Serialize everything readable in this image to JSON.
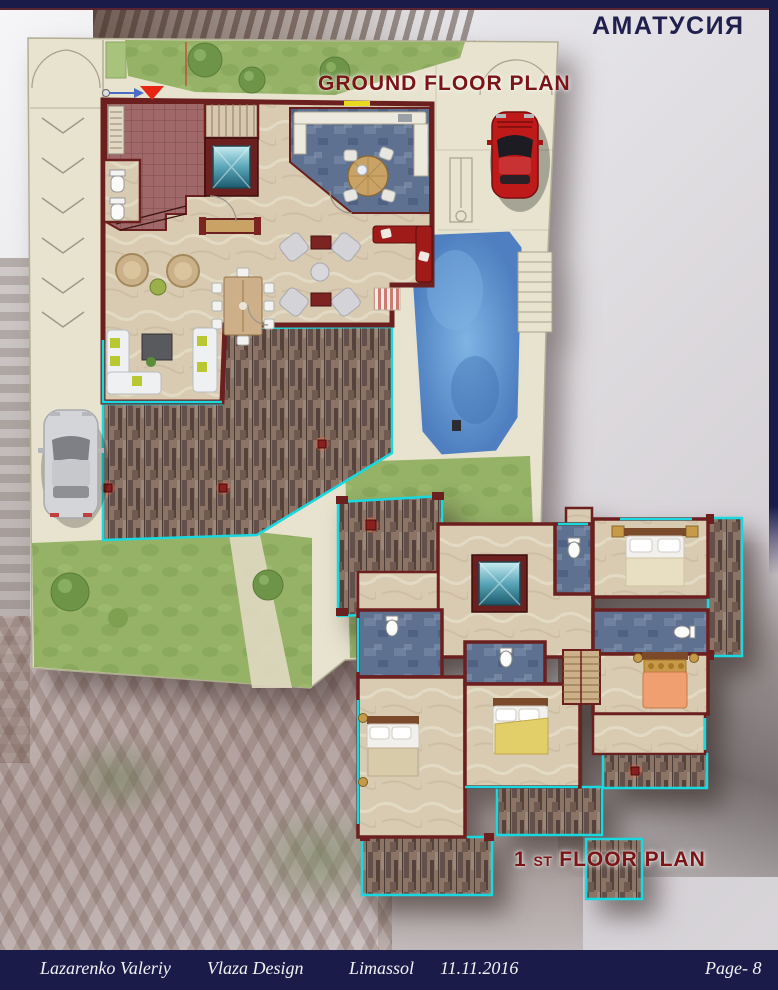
{
  "header": {
    "project_title": "АМАТУСИЯ"
  },
  "ground_plan": {
    "label": "GROUND FLOOR PLAN",
    "features": [
      "driveway-with-chevrons",
      "entrance-gate-arcs",
      "silver-car",
      "red-car",
      "garden-trees",
      "lawn-with-path",
      "swimming-pool",
      "pool-steps",
      "wood-deck",
      "entry-hall-red-tiles",
      "wc",
      "elevator",
      "staircase",
      "kitchen-blue-floor",
      "round-kitchen-table",
      "red-corner-sofa",
      "dining-table-8-chairs",
      "armchair-lounge",
      "white-sofas",
      "tv-cabinet",
      "bench",
      "entrance-marker"
    ]
  },
  "first_plan": {
    "label_num": "1",
    "label_st": "ST",
    "label_rest": "FLOOR PLAN",
    "features": [
      "four-bedrooms",
      "four-bathrooms-blue-floor",
      "elevator",
      "staircase",
      "wood-balconies",
      "terrace-decks"
    ]
  },
  "footer": {
    "author": "Lazarenko Valeriy",
    "studio": "Vlaza Design",
    "city": "Limassol",
    "date": "11.11.2016",
    "page": "Page- 8"
  },
  "colors": {
    "navy_frame": "#1b1b4a",
    "maroon_label": "#7a1416",
    "wall_red": "#6b1f1e",
    "marble_floor": "#d8cbb2",
    "entry_tile": "#a06868",
    "blue_tile_floor": "#5e7191",
    "pool_water": "#5d90cc",
    "deck_wood": "#8b7466",
    "cyan_trim": "#19d8e0",
    "lawn_green": "#95b267",
    "paving": "#e7e3cf",
    "red_car": "#bf1a1a",
    "silver_car": "#d4d5d8",
    "red_sofa": "#9e1b1a"
  }
}
